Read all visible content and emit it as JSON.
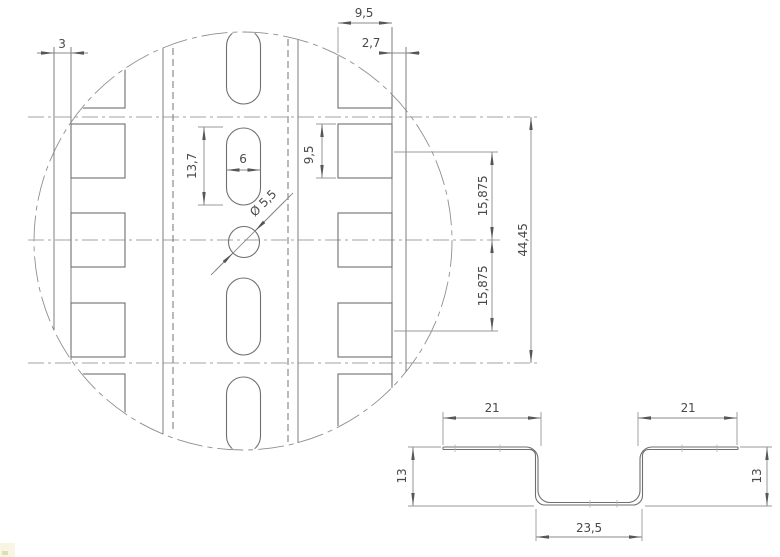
{
  "top_view": {
    "edge_margin_left": "3",
    "square_hole_width": "9,5",
    "edge_margin_right": "2,7",
    "slot_length": "13,7",
    "slot_width": "6",
    "hole_diameter": "Ø 5,5",
    "square_hole_height": "9,5",
    "hole_pitch_upper": "15,875",
    "hole_pitch_lower": "15,875",
    "hole_pattern_span": "44,45"
  },
  "section_view": {
    "flange_width_left": "21",
    "flange_width_right": "21",
    "profile_height_left": "13",
    "profile_height_right": "13",
    "channel_width": "23,5"
  }
}
